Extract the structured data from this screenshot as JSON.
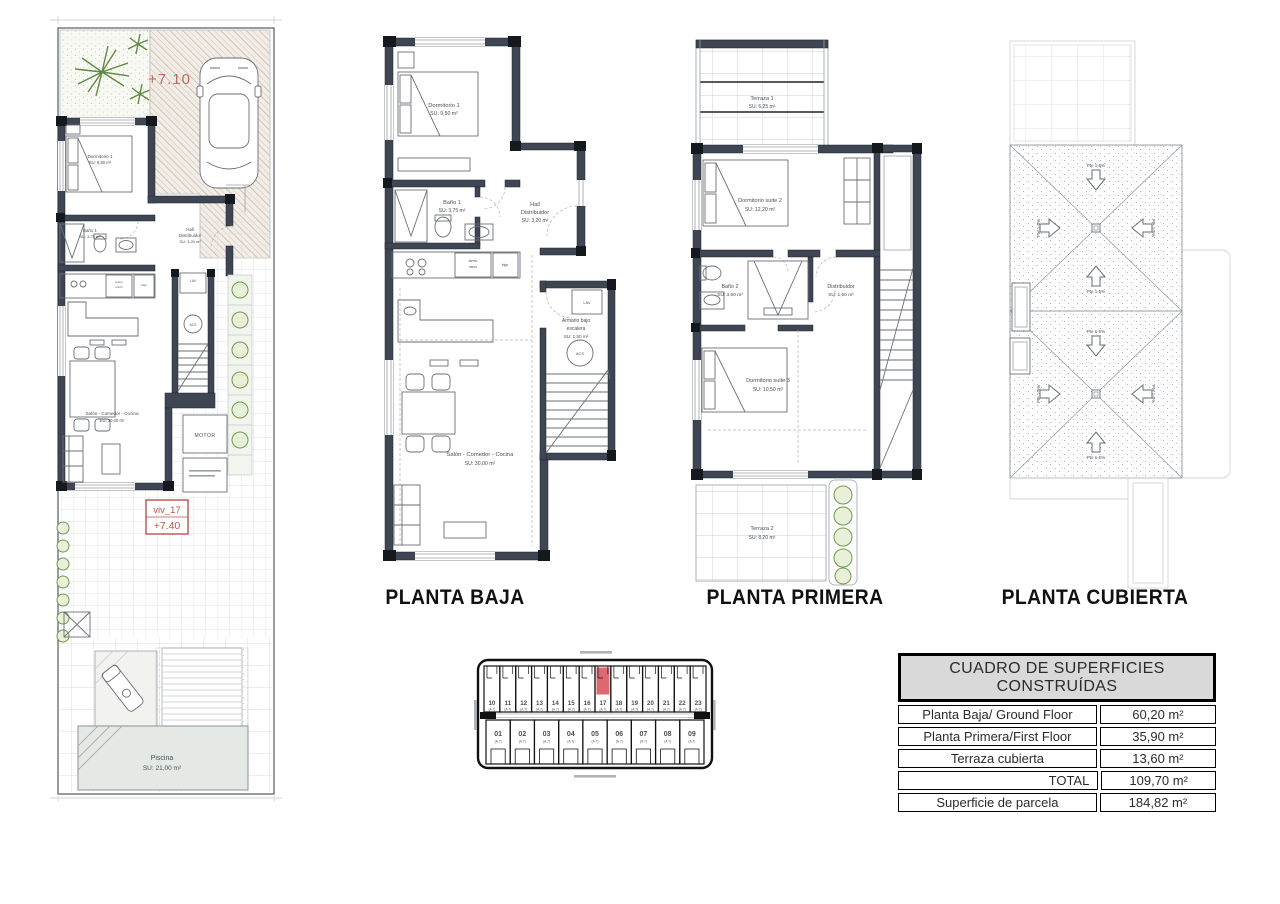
{
  "site_plan": {
    "level_top": "+7.10",
    "unit_label": "viv_17",
    "unit_level": "+7.40",
    "rooms": {
      "dormitorio": {
        "name": "Dormitorio 1",
        "area": "SU: 9,50 m²"
      },
      "bano": {
        "name": "Baño 1",
        "area": "SU: 3,75 m²"
      },
      "hall": {
        "line1": "Hall",
        "line2": "Distribuidor",
        "area": "SU: 3,20 m²"
      },
      "salon": {
        "name": "Salón - Comedor - Cocina",
        "area": "SU: 30,00 m²"
      },
      "piscina": {
        "name": "Piscina",
        "area": "SU: 21,00 m²"
      }
    },
    "motor_label": "MOTOR"
  },
  "planta_baja": {
    "title": "PLANTA BAJA",
    "dormitorio": {
      "name": "Dormitorio 1",
      "area": "SU: 9,50 m²"
    },
    "bano": {
      "name": "Baño 1",
      "area": "SU: 3,75 m²"
    },
    "hall": {
      "line1": "Hall",
      "line2": "Distribuidor",
      "area": "SU: 3,20 m²"
    },
    "armario": {
      "line1": "Armario bajo",
      "line2": "escalera",
      "area": "SU: 1,50 m²"
    },
    "salon": {
      "name": "Salón - Comedor - Cocina",
      "area": "SU: 30,00 m²"
    },
    "labels": {
      "lav": "LAV",
      "acs": "ACS",
      "termo": "termo",
      "micro": "micro",
      "frigo": "frigo"
    }
  },
  "planta_primera": {
    "title": "PLANTA PRIMERA",
    "terraza1": {
      "name": "Terraza 1",
      "area": "SU: 6,25 m²"
    },
    "suite2": {
      "name": "Dormitorio suite 2",
      "area": "SU: 12,20 m²"
    },
    "bano2": {
      "name": "Baño 2",
      "area": "SU: 3,60 m²"
    },
    "distribuidor": {
      "name": "Distribuidor",
      "area": "SU: 1,60 m²"
    },
    "suite3": {
      "name": "Dormitorio suite 3",
      "area": "SU: 10,50 m²"
    },
    "terraza2": {
      "name": "Terraza 2",
      "area": "SU: 8,20 m²"
    }
  },
  "planta_cubierta": {
    "title": "PLANTA CUBIERTA",
    "slope_label": "Pte 1-5%"
  },
  "key_plan": {
    "top_row": [
      "10",
      "11",
      "12",
      "13",
      "14",
      "15",
      "16",
      "17",
      "18",
      "19",
      "20",
      "21",
      "22",
      "23"
    ],
    "bottom_row": [
      "01",
      "02",
      "03",
      "04",
      "05",
      "06",
      "07",
      "08",
      "09"
    ],
    "highlighted": "17",
    "sub_label": "(A.7)",
    "highlight_color": "#dd6a71"
  },
  "areas_table": {
    "title": "CUADRO DE SUPERFICIES CONSTRUÍDAS",
    "rows": [
      {
        "label": "Planta Baja/ Ground Floor",
        "value": "60,20 m²"
      },
      {
        "label": "Planta Primera/First Floor",
        "value": "35,90 m²"
      },
      {
        "label": "Terraza cubierta",
        "value": "13,60 m²"
      },
      {
        "label": "TOTAL",
        "value": "109,70 m²"
      },
      {
        "label": "Superficie de parcela",
        "value": "184,82 m²"
      }
    ]
  },
  "colors": {
    "wall": "#3e4553",
    "accent_red": "#b9534c",
    "green": "#6f9a4c",
    "highlight": "#dd6a71"
  }
}
